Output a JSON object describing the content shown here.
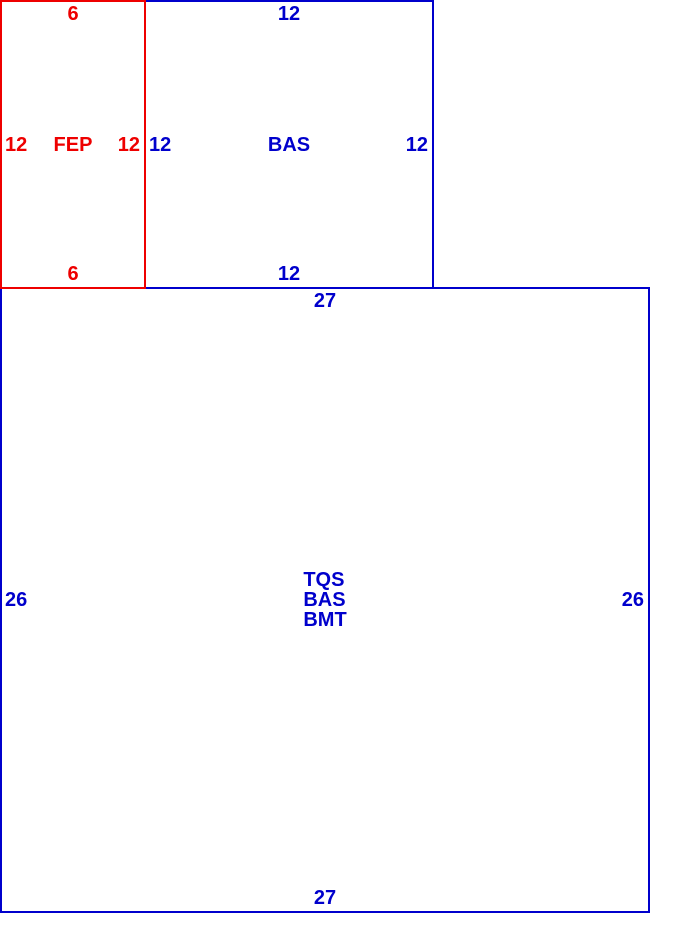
{
  "sketch": {
    "background": "#ffffff",
    "areas": [
      {
        "label": "FEP",
        "color": "#ee0000",
        "dim_top": "6",
        "dim_left": "12",
        "dim_right": "12",
        "dim_bottom": "6"
      },
      {
        "label": "BAS",
        "color": "#0000cc",
        "dim_top": "12",
        "dim_left": "12",
        "dim_right": "12",
        "dim_bottom": "12"
      },
      {
        "label_lines": [
          "TQS",
          "BAS",
          "BMT"
        ],
        "color": "#0000cc",
        "dim_top": "27",
        "dim_left": "26",
        "dim_right": "26",
        "dim_bottom": "27"
      }
    ]
  }
}
